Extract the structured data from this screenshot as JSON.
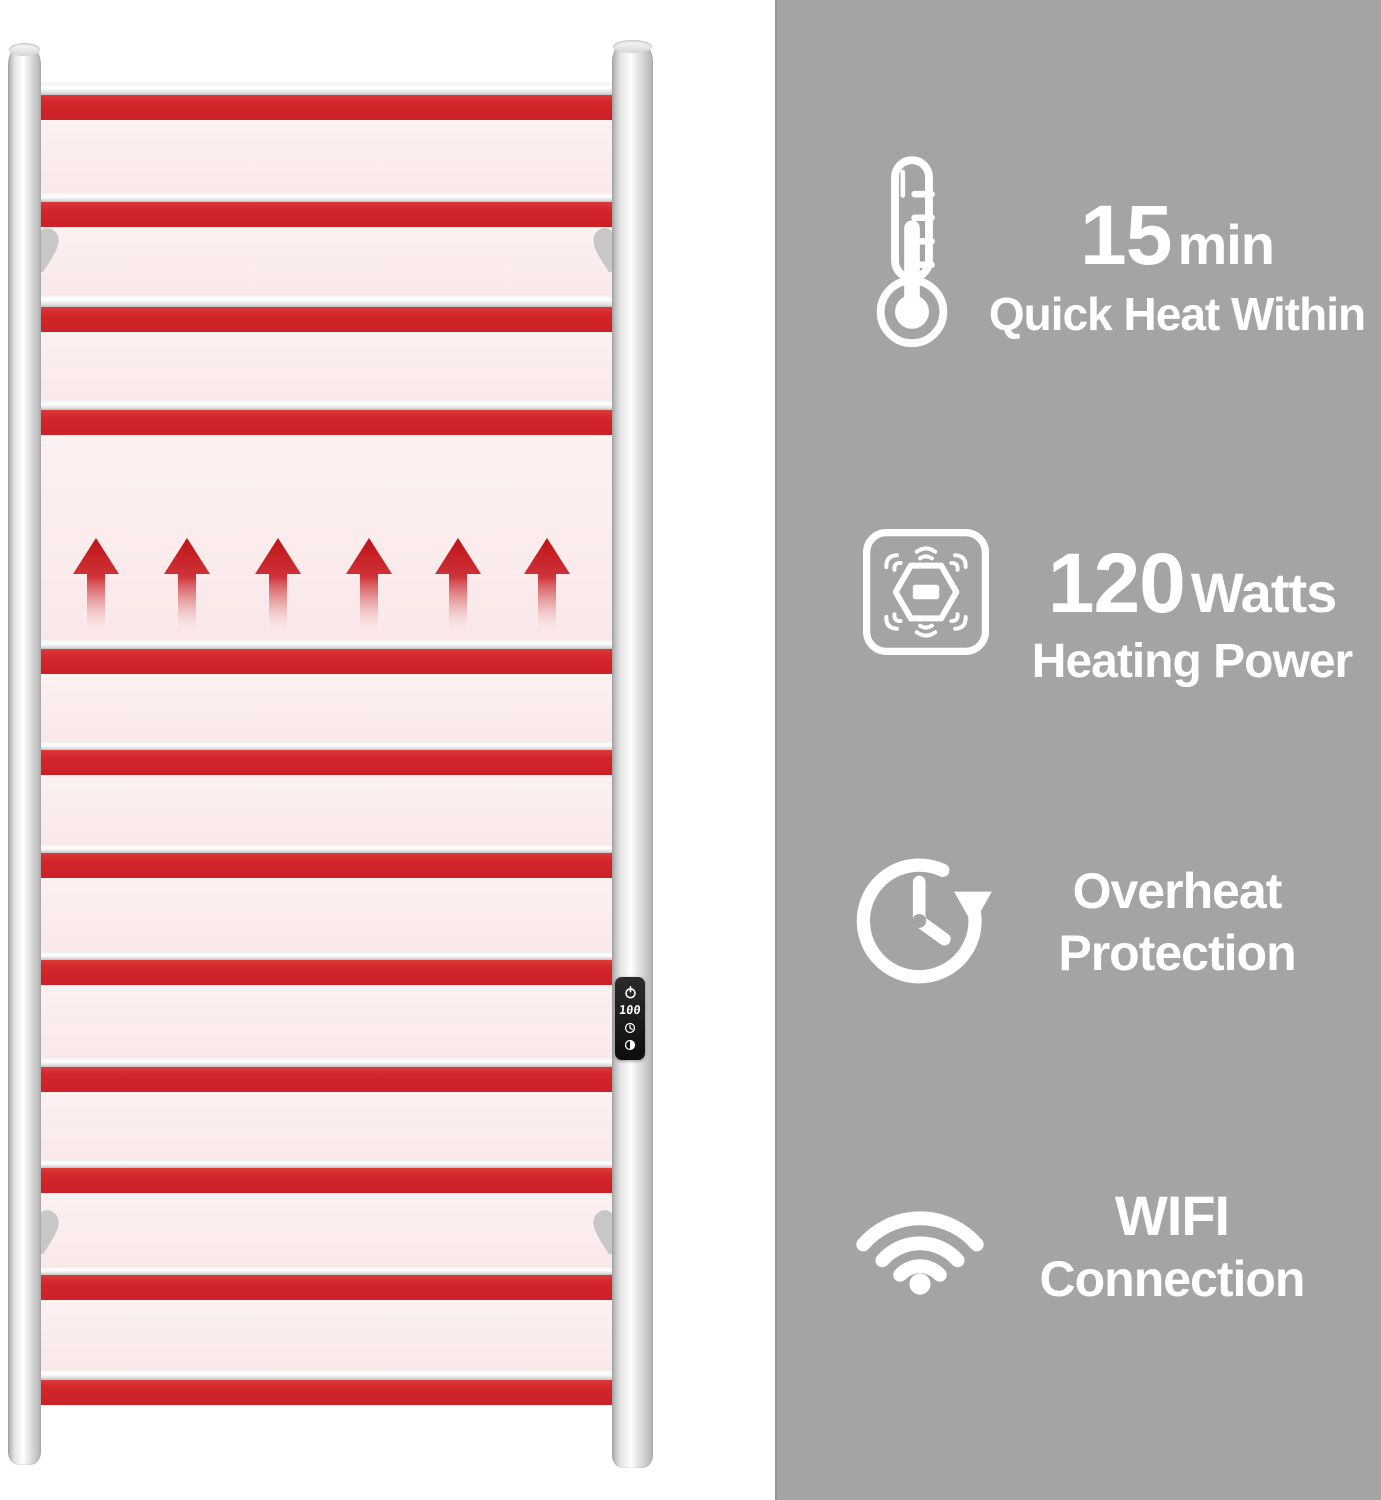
{
  "colors": {
    "panel_gray": "#a4a4a4",
    "heat_red": "#d2262b",
    "heat_glow_pink": "#fae8e9",
    "chrome_silver": "#dcdcdc",
    "controller_black": "#161616",
    "icon_text_white": "#ffffff"
  },
  "rack": {
    "rung_count": 12,
    "heat_arrow_count": 6,
    "wall_bracket_count": 4,
    "control_panel": {
      "display_value": "100",
      "buttons": [
        "power-icon",
        "clock-timer-icon",
        "heat-level-icon"
      ]
    }
  },
  "features": [
    {
      "name": "quick-heat",
      "icon": "thermometer-icon",
      "value": "15",
      "unit": "min",
      "label": "Quick Heat Within"
    },
    {
      "name": "heating-power",
      "icon": "heating-power-icon",
      "value": "120",
      "unit": "Watts",
      "label": "Heating Power"
    },
    {
      "name": "overheat-protection",
      "icon": "overheat-clock-icon",
      "line1": "Overheat",
      "line2": "Protection"
    },
    {
      "name": "wifi-connection",
      "icon": "wifi-icon",
      "line1": "WIFI",
      "line2": "Connection"
    }
  ]
}
